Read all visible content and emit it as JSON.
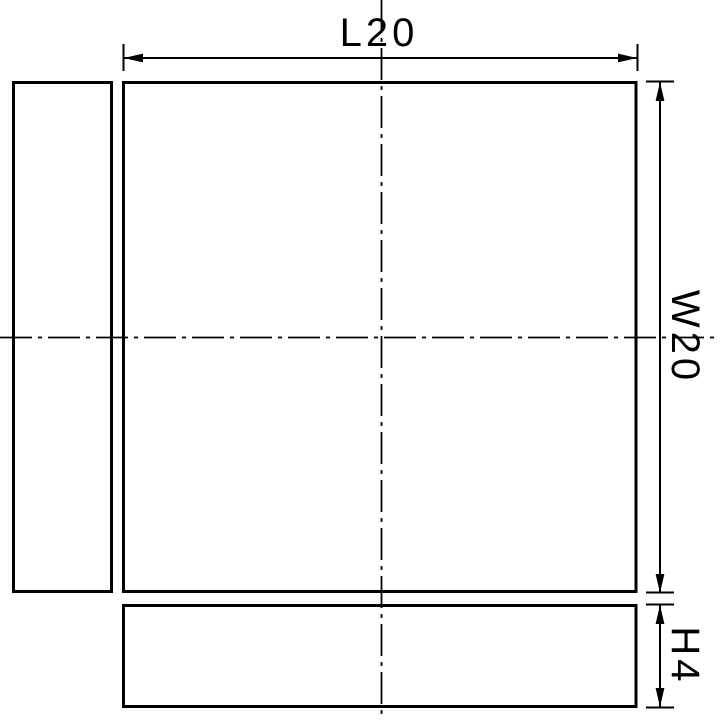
{
  "colors": {
    "background": "#ffffff",
    "line": "#000000"
  },
  "dimensions": {
    "length": "L20",
    "width": "W20",
    "height": "H4"
  }
}
